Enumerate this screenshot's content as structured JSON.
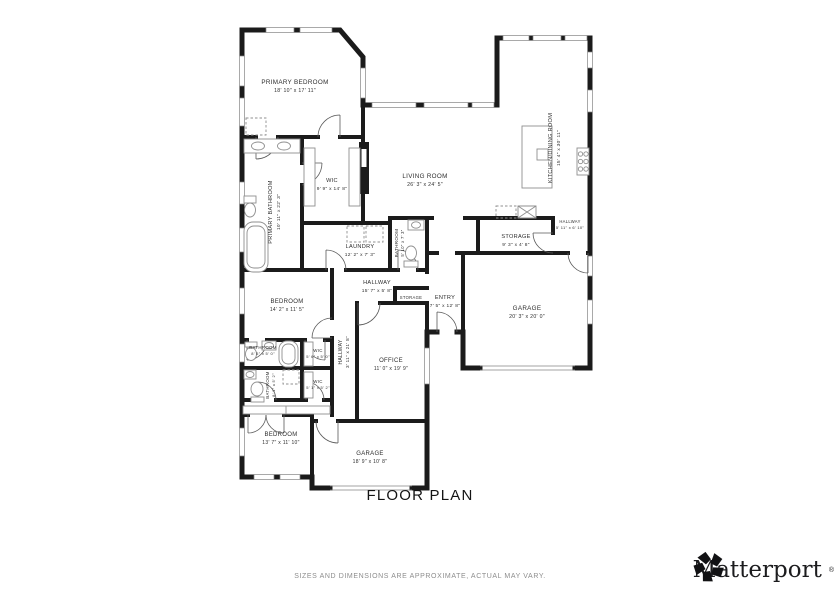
{
  "plan": {
    "title": "FLOOR PLAN",
    "rooms": {
      "primary_bedroom": {
        "name": "PRIMARY BEDROOM",
        "dims": "18' 10\" x 17' 11\""
      },
      "primary_wic": {
        "name": "WIC",
        "dims": "9' 9\" x 14' 8\""
      },
      "living_room": {
        "name": "LIVING ROOM",
        "dims": "26' 3\" x 24' 5\""
      },
      "kitchen_dining": {
        "name": "KITCHEN/DINING ROOM",
        "dims": "15' 4\" x 30' 11\""
      },
      "primary_bathroom": {
        "name": "PRIMARY BATHROOM",
        "dims": "10' 11\" x 22' 3\""
      },
      "laundry": {
        "name": "LAUNDRY",
        "dims": "12' 2\" x 7' 3\""
      },
      "hall_bathroom": {
        "name": "BATHROOM",
        "dims": "5' 10\" x 7' 3\""
      },
      "kitchen_hallway": {
        "name": "HALLWAY",
        "dims": "5' 11\" x 6' 10\""
      },
      "storage": {
        "name": "STORAGE",
        "dims": "9' 3\" x 4' 8\""
      },
      "garage": {
        "name": "GARAGE",
        "dims": "20' 3\" x 20' 0\""
      },
      "entry": {
        "name": "ENTRY",
        "dims": "7' 5\" x 12' 8\""
      },
      "main_hallway": {
        "name": "HALLWAY",
        "dims": "15' 7\" x 5' 8\""
      },
      "entry_storage": {
        "name": "STORAGE"
      },
      "middle_bedroom": {
        "name": "BEDROOM",
        "dims": "14' 2\" x 11' 5\""
      },
      "bathroom_2": {
        "name": "BATHROOM",
        "dims": "8' 5\" x 5' 0\""
      },
      "wic_2": {
        "name": "WIC",
        "dims": "5' 6\" x 5' 0\""
      },
      "wic_3": {
        "name": "WIC",
        "dims": "5' 1\" x 5' 2\""
      },
      "bathroom_3": {
        "name": "BATHROOM",
        "dims": "8' 1\" x 5' 2\""
      },
      "long_hallway": {
        "name": "HALLWAY",
        "dims": "3' 11\" x 21' 8\""
      },
      "office": {
        "name": "OFFICE",
        "dims": "11' 0\" x 19' 9\""
      },
      "bedroom_3": {
        "name": "BEDROOM",
        "dims": "13' 7\" x 11' 10\""
      },
      "garage_2": {
        "name": "GARAGE",
        "dims": "18' 9\" x 10' 8\""
      }
    }
  },
  "footer": {
    "disclaimer": "SIZES AND DIMENSIONS ARE APPROXIMATE, ACTUAL MAY VARY.",
    "brand": "Matterport",
    "brand_mark": "®"
  },
  "colors": {
    "wall": "#1b1b1b",
    "fixture": "#8f8f8f",
    "label": "#2e2e2e",
    "disclaimer": "#8d8d8d"
  }
}
